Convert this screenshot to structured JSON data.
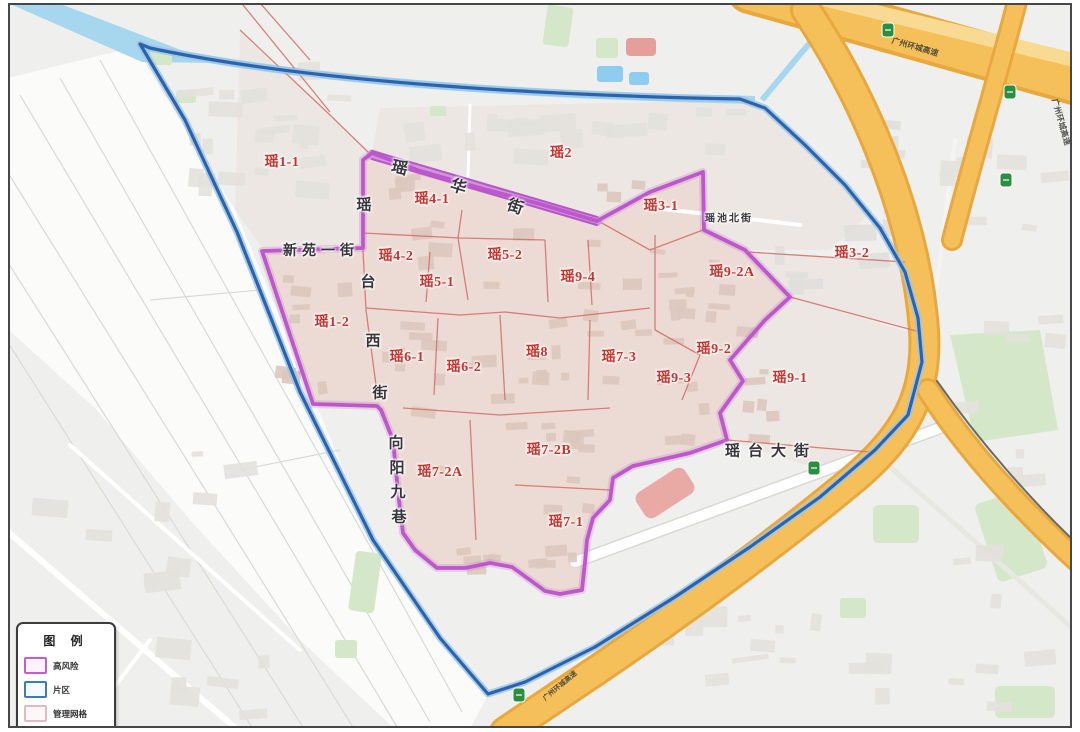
{
  "map": {
    "label_color": "#c8322b",
    "region_labels": [
      {
        "text": "瑶1-1",
        "x": 282,
        "y": 161
      },
      {
        "text": "瑶2",
        "x": 561,
        "y": 152
      },
      {
        "text": "瑶4-1",
        "x": 432,
        "y": 198
      },
      {
        "text": "瑶3-1",
        "x": 661,
        "y": 205
      },
      {
        "text": "瑶3-2",
        "x": 852,
        "y": 252
      },
      {
        "text": "瑶4-2",
        "x": 396,
        "y": 255
      },
      {
        "text": "瑶5-2",
        "x": 505,
        "y": 254
      },
      {
        "text": "瑶5-1",
        "x": 437,
        "y": 281
      },
      {
        "text": "瑶9-4",
        "x": 578,
        "y": 276
      },
      {
        "text": "瑶9-2A",
        "x": 732,
        "y": 271
      },
      {
        "text": "瑶1-2",
        "x": 332,
        "y": 321
      },
      {
        "text": "瑶6-1",
        "x": 407,
        "y": 356
      },
      {
        "text": "瑶6-2",
        "x": 464,
        "y": 366
      },
      {
        "text": "瑶8",
        "x": 537,
        "y": 351
      },
      {
        "text": "瑶7-3",
        "x": 619,
        "y": 356
      },
      {
        "text": "瑶9-2",
        "x": 714,
        "y": 348
      },
      {
        "text": "瑶9-3",
        "x": 674,
        "y": 377
      },
      {
        "text": "瑶9-1",
        "x": 790,
        "y": 377
      },
      {
        "text": "瑶7-2B",
        "x": 549,
        "y": 449
      },
      {
        "text": "瑶7-2A",
        "x": 440,
        "y": 471
      },
      {
        "text": "瑶7-1",
        "x": 566,
        "y": 521
      }
    ],
    "street_labels": [
      {
        "name": "yaohua-street",
        "text": "瑶华街",
        "mode": "chars",
        "size": 16,
        "chars": [
          {
            "t": "瑶",
            "x": 400,
            "y": 166,
            "r": 13
          },
          {
            "t": "华",
            "x": 459,
            "y": 185,
            "r": 17
          },
          {
            "t": "街",
            "x": 516,
            "y": 205,
            "r": 19
          }
        ]
      },
      {
        "name": "yaotai-west-street",
        "text": "瑶台西街",
        "mode": "chars",
        "size": 15,
        "chars": [
          {
            "t": "瑶",
            "x": 364,
            "y": 204,
            "r": 0
          },
          {
            "t": "台",
            "x": 368,
            "y": 281,
            "r": 0
          },
          {
            "t": "西",
            "x": 373,
            "y": 340,
            "r": 0
          },
          {
            "t": "街",
            "x": 380,
            "y": 392,
            "r": 0
          }
        ]
      },
      {
        "name": "xiangyang-jiu-lane",
        "text": "向阳九巷",
        "mode": "chars",
        "size": 15,
        "chars": [
          {
            "t": "向",
            "x": 396,
            "y": 442,
            "r": 0
          },
          {
            "t": "阳",
            "x": 397,
            "y": 467,
            "r": 0
          },
          {
            "t": "九",
            "x": 398,
            "y": 491,
            "r": 0
          },
          {
            "t": "巷",
            "x": 399,
            "y": 516,
            "r": 0
          }
        ]
      },
      {
        "name": "xinyuan-first-street",
        "text": "新苑一街",
        "mode": "h",
        "x": 321,
        "y": 250,
        "size": 14,
        "spacing": 5
      },
      {
        "name": "yaotai-avenue",
        "text": "瑶台大街",
        "mode": "h",
        "x": 771,
        "y": 450,
        "size": 15,
        "spacing": 8
      },
      {
        "name": "yaochi-north-street",
        "text": "瑶池北街",
        "mode": "h",
        "x": 729,
        "y": 217,
        "size": 10,
        "spacing": 2
      }
    ],
    "highway_labels": [
      {
        "text": "广州环城高速",
        "x": 915,
        "y": 47,
        "r": 16,
        "size": 8
      },
      {
        "text": "广州环城高速",
        "x": 1061,
        "y": 122,
        "r": 74,
        "size": 8
      },
      {
        "text": "广州环城高速",
        "x": 560,
        "y": 686,
        "r": -40,
        "size": 7
      }
    ]
  },
  "legend": {
    "title": "图 例",
    "items": [
      {
        "label": "高风险",
        "swatch_border": "#c25ecf",
        "swatch_fill": "#fdf3fb"
      },
      {
        "label": "片区",
        "swatch_border": "#3c79bd",
        "swatch_fill": "#f4fbff"
      },
      {
        "label": "管理网格",
        "swatch_border": "#e4b9c0",
        "swatch_fill": "#fdf8f7"
      }
    ]
  },
  "boundary_colors": {
    "high_risk": "#bc58cb",
    "district": "#2c63ad",
    "management_grid": "#d4736b",
    "highway": "#f5c05a",
    "water": "#a7d7ee"
  }
}
